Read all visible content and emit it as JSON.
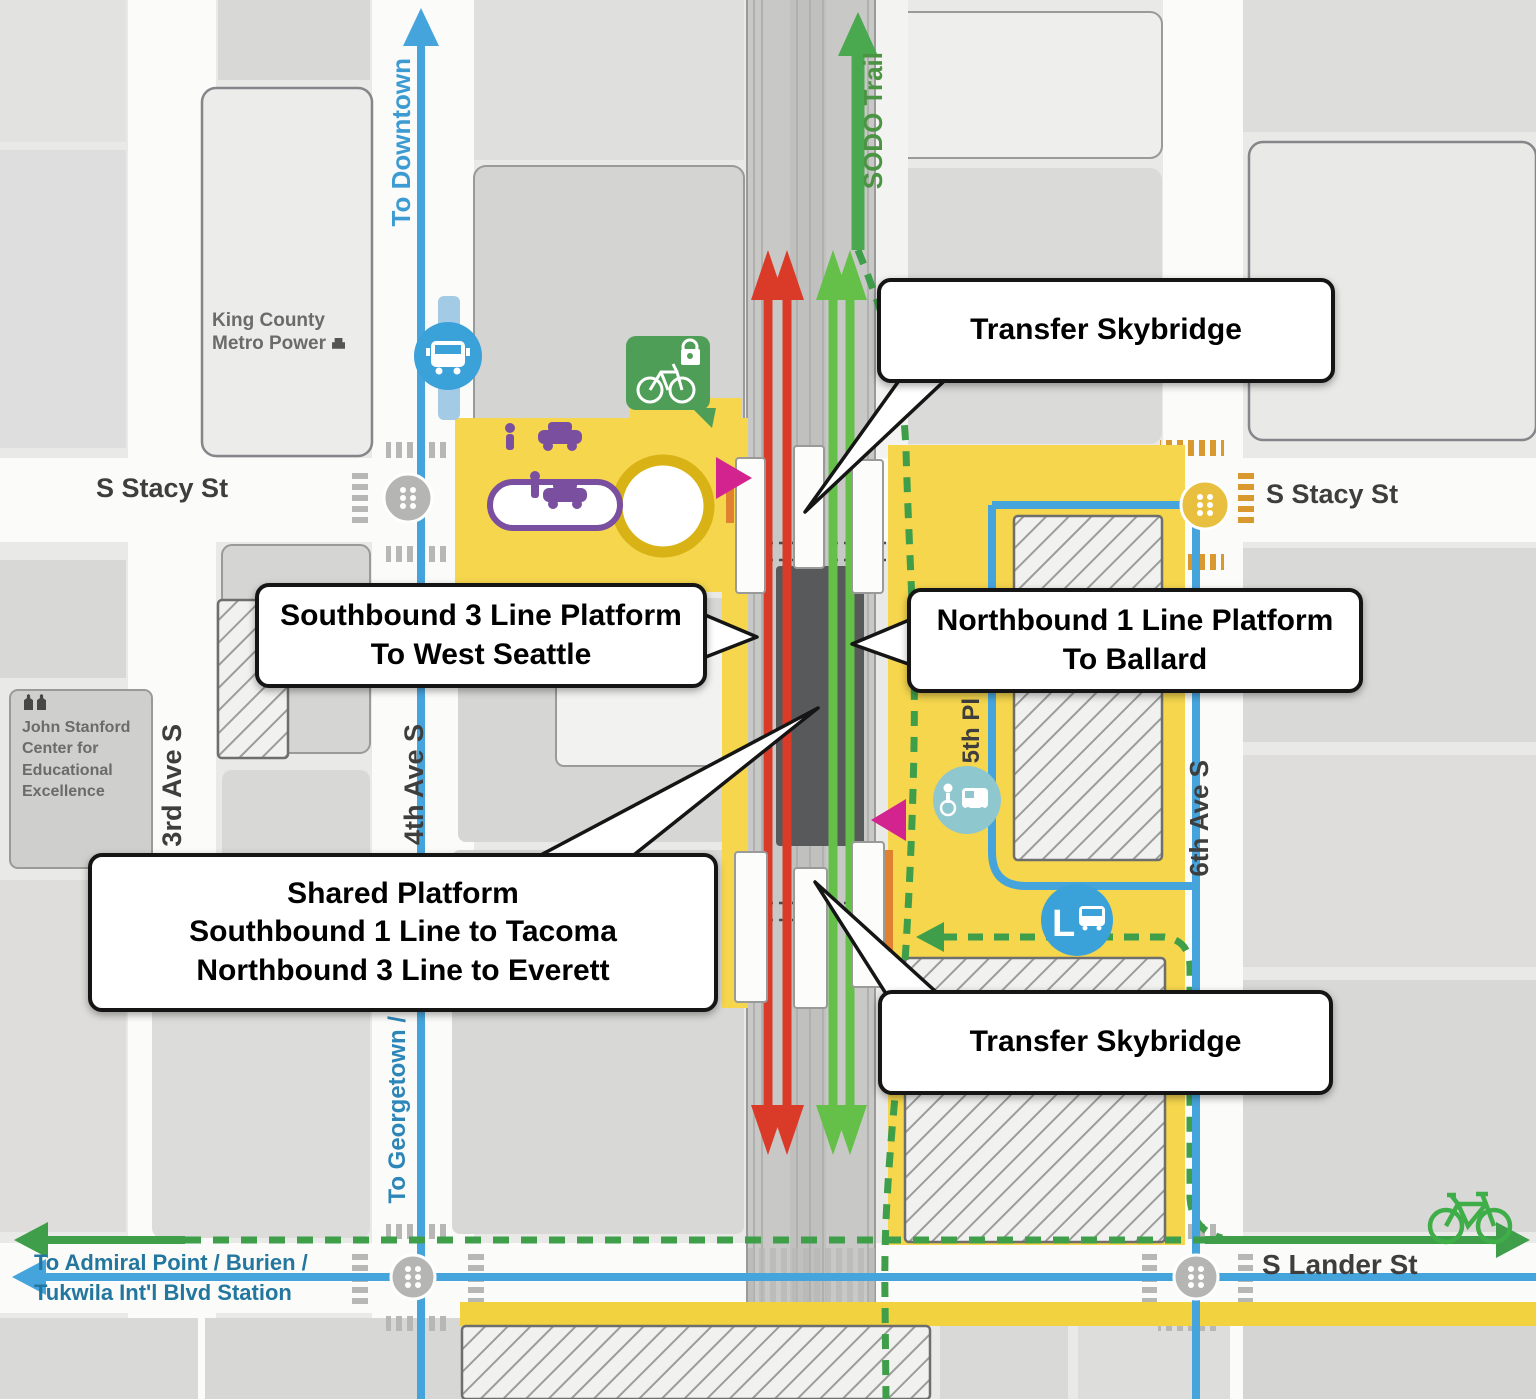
{
  "labels": {
    "streets": {
      "stacy_left": "S Stacy St",
      "stacy_right": "S Stacy St",
      "lander": "S Lander St",
      "ave3": "3rd Ave S",
      "ave4": "4th Ave S",
      "ave5": "5th Pl",
      "ave6": "6th Ave S"
    },
    "directions": {
      "downtown": "To Downtown",
      "sodo_trail": "SODO Trail",
      "georgetown": "To Georgetown / B",
      "admiral_line1": "To Admiral Point / Burien /",
      "admiral_line2": "Tukwila Int'l Blvd Station"
    },
    "places": {
      "king_county_line1": "King County",
      "king_county_line2": "Metro Power",
      "stanford_line1": "John Stanford",
      "stanford_line2": "Center for",
      "stanford_line3": "Educational",
      "stanford_line4": "Excellence"
    }
  },
  "callouts": {
    "transfer_top": "Transfer Skybridge",
    "southbound3_line1": "Southbound 3 Line Platform",
    "southbound3_line2": "To West Seattle",
    "northbound1_line1": "Northbound 1 Line Platform",
    "northbound1_line2": "To Ballard",
    "shared_line1": "Shared Platform",
    "shared_line2": "Southbound 1 Line to Tacoma",
    "shared_line3": "Northbound 3 Line to Everett",
    "transfer_bottom": "Transfer Skybridge"
  },
  "icons": {
    "layover_label": "L"
  },
  "colors": {
    "line_red": "#d93b28",
    "line_green": "#65c04a",
    "route_blue": "#46a4dc",
    "trail_green": "#3f9e4a",
    "plaza_yellow": "#f5d64d",
    "entrance_magenta": "#d2238f",
    "pickup_purple": "#7b4fa0",
    "platform_dark": "#58595b",
    "crosswalk_orange": "#d9992f"
  }
}
